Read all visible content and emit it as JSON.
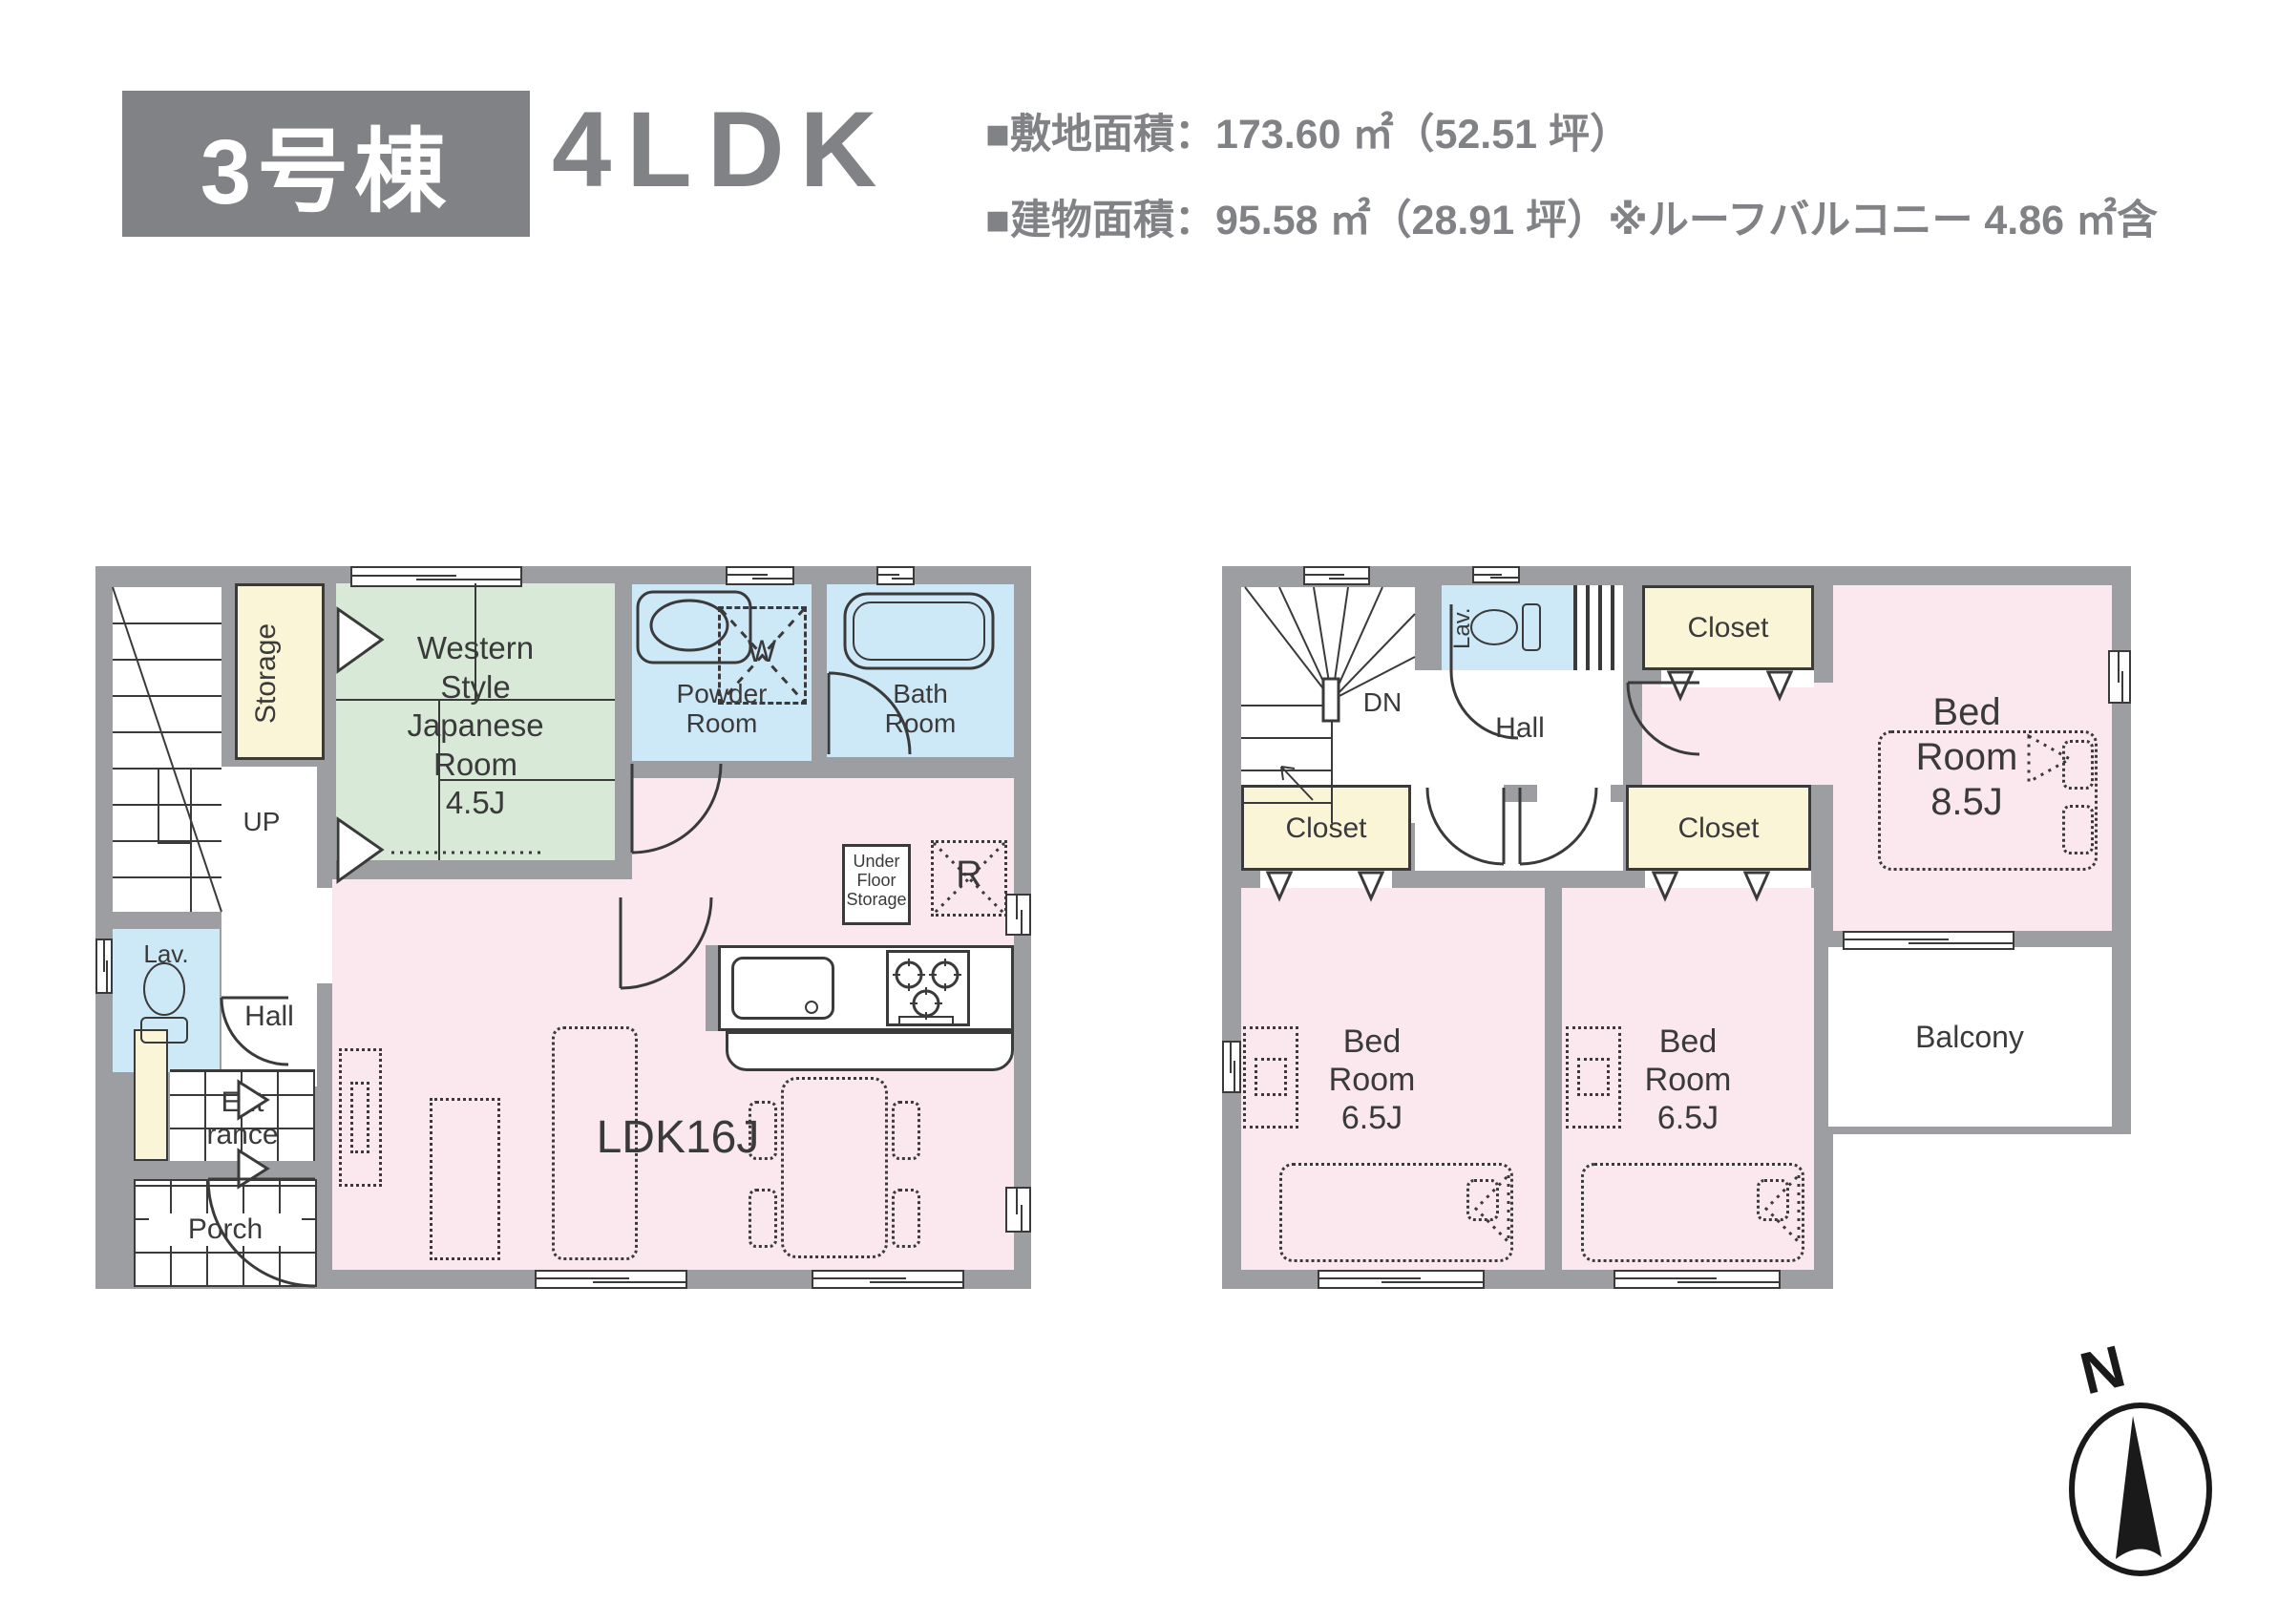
{
  "header": {
    "building_badge": "3号棟",
    "plan_type": "4LDK",
    "site_area": "■敷地面積：173.60 ㎡（52.51 坪）",
    "building_area": "■建物面積：95.58 ㎡（28.91 坪）※ルーフバルコニー 4.86 ㎡含"
  },
  "colors": {
    "wall": "#9c9ea1",
    "badge_gray": "#808285",
    "text_gray": "#808285",
    "line": "#3a3a3b",
    "room_pink": "#fbe7ee",
    "room_blue": "#cde8f6",
    "room_green": "#d8e9d8",
    "room_yellow": "#fbf5d8"
  },
  "floor1": {
    "storage": "Storage",
    "up": "UP",
    "japanese_room": {
      "lines": [
        "Western",
        "Style",
        "Japanese",
        "Room",
        "4.5J"
      ]
    },
    "powder_room": {
      "lines": [
        "Powder",
        "Room"
      ]
    },
    "washer": "W",
    "bath_room": {
      "lines": [
        "Bath",
        "Room"
      ]
    },
    "lavatory": "Lav.",
    "hall": "Hall",
    "entrance": {
      "lines": [
        "Ent",
        "rance"
      ]
    },
    "porch": "Porch",
    "ldk": "LDK16J",
    "under_floor_storage": {
      "lines": [
        "Under",
        "Floor",
        "Storage"
      ]
    },
    "refrigerator": "R"
  },
  "floor2": {
    "down": "DN",
    "lavatory": "Lav.",
    "hall": "Hall",
    "closet_top": "Closet",
    "closet_left": "Closet",
    "closet_middle": "Closet",
    "bedroom_main": {
      "lines": [
        "Bed",
        "Room",
        "8.5J"
      ]
    },
    "bedroom_left": {
      "lines": [
        "Bed",
        "Room",
        "6.5J"
      ]
    },
    "bedroom_middle": {
      "lines": [
        "Bed",
        "Room",
        "6.5J"
      ]
    },
    "balcony": "Balcony"
  },
  "compass": {
    "north": "N"
  }
}
